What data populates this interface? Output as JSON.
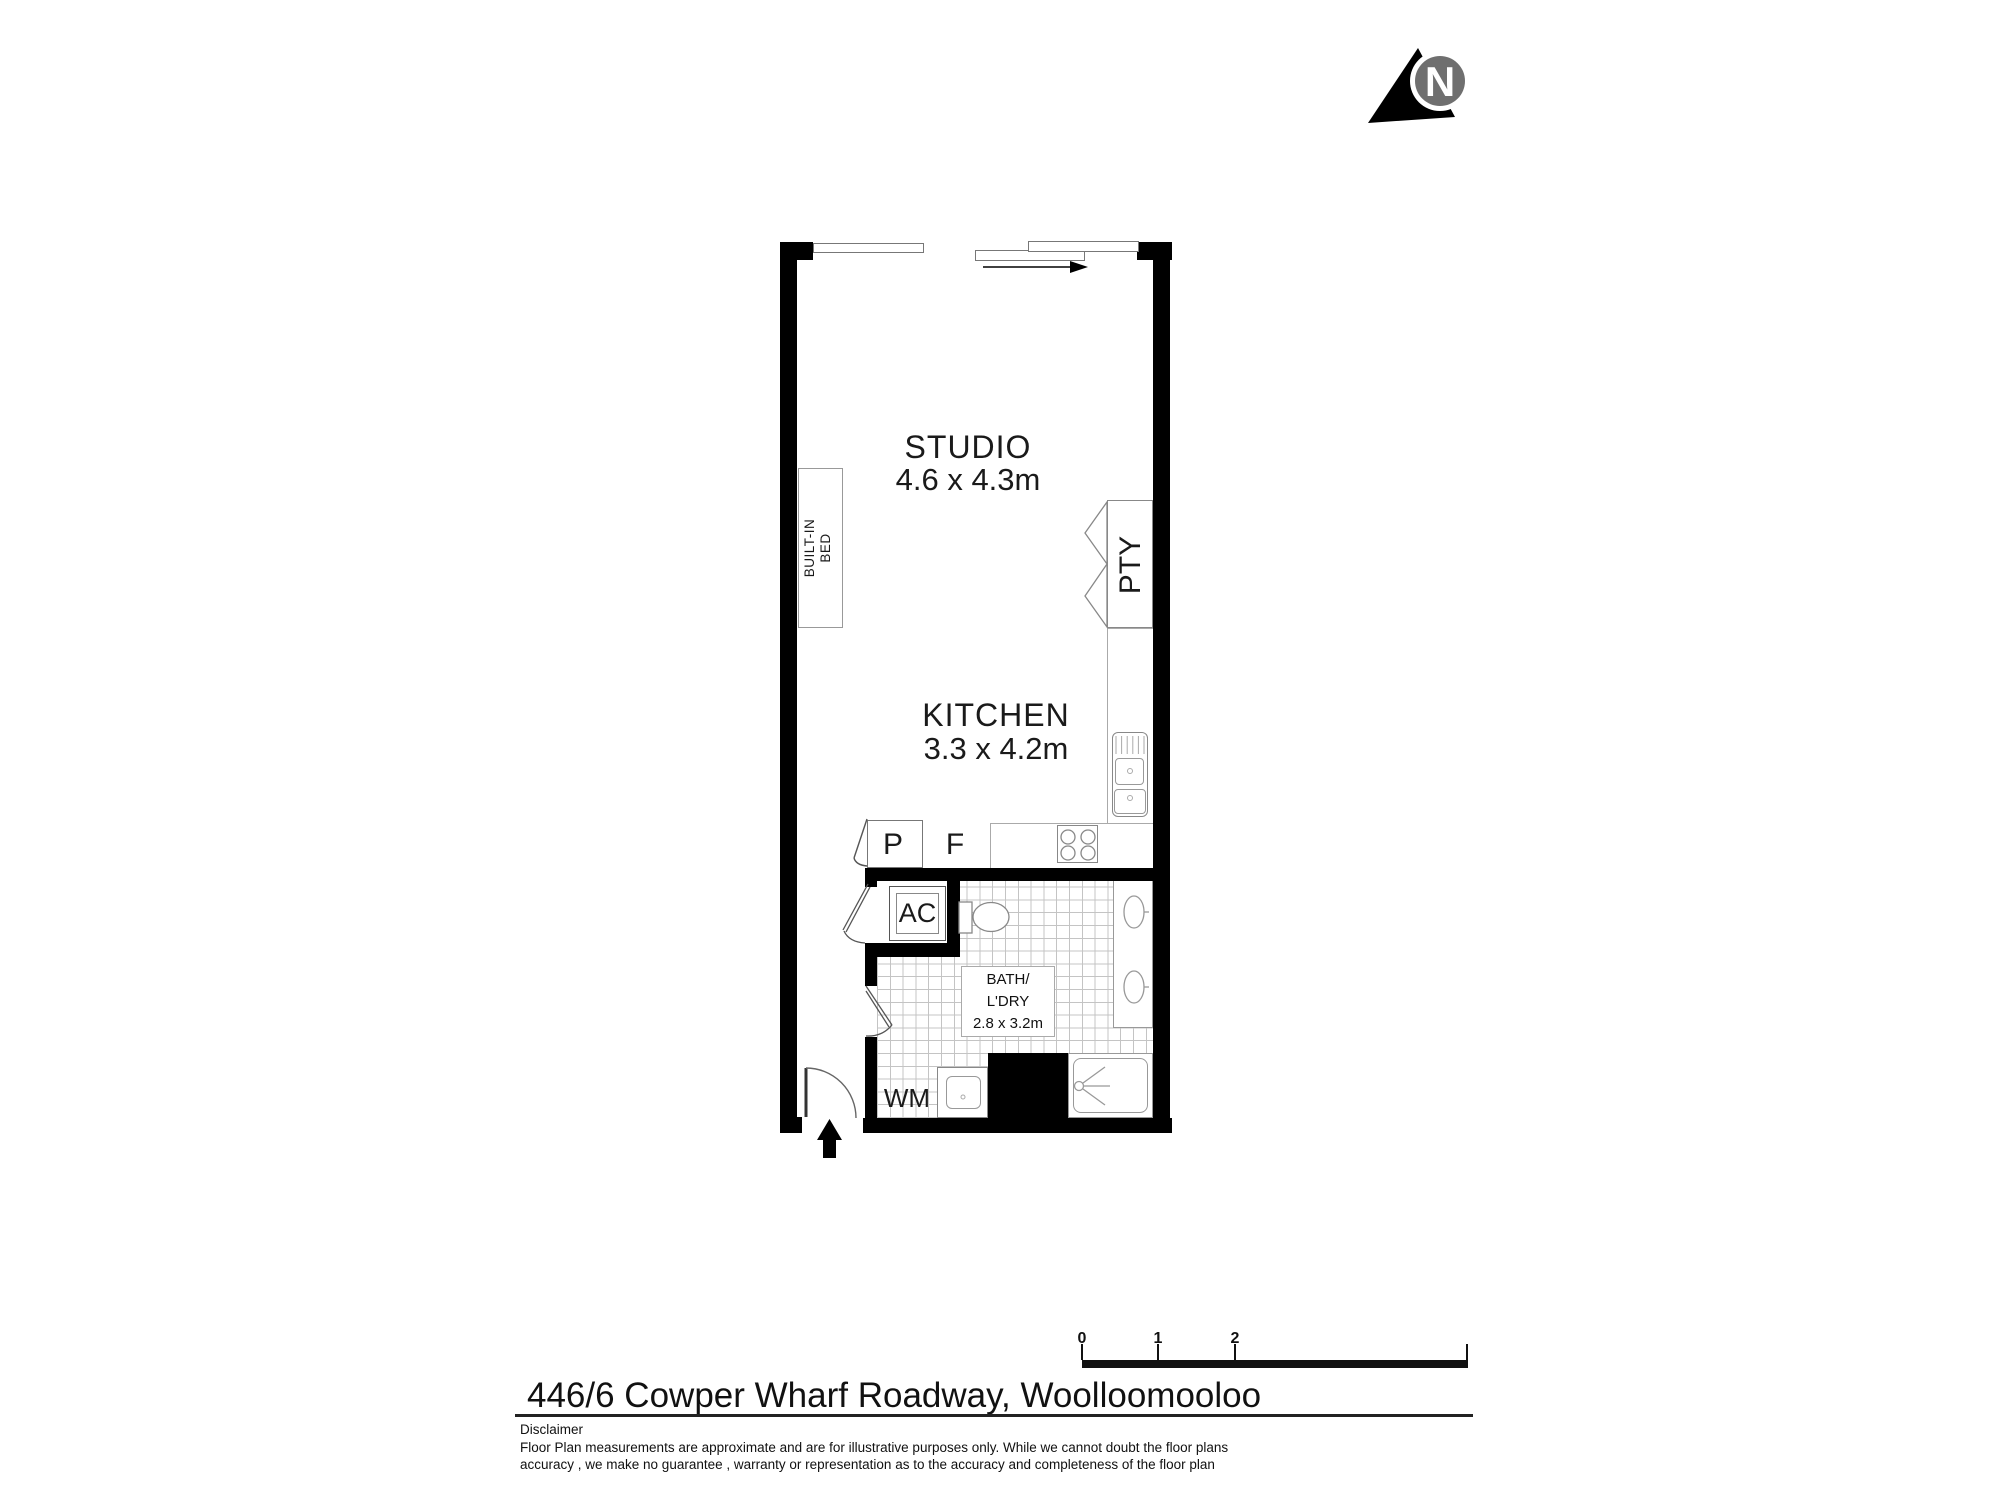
{
  "north": {
    "label": "N"
  },
  "rooms": {
    "studio": {
      "name": "STUDIO",
      "dims": "4.6 x 4.3m"
    },
    "kitchen": {
      "name": "KITCHEN",
      "dims": "3.3 x 4.2m"
    },
    "bath": {
      "name_line1": "BATH/",
      "name_line2": "L'DRY",
      "dims": "2.8 x 3.2m"
    }
  },
  "fixtures": {
    "built_in_bed_line1": "BUILT-IN",
    "built_in_bed_line2": "BED",
    "pantry": "PTY",
    "air_con": "AC",
    "cupboard": "P",
    "fridge": "F",
    "washing_machine": "WM"
  },
  "scale_bar": {
    "ticks": [
      "0",
      "1",
      "2",
      "5"
    ]
  },
  "footer": {
    "address": "446/6 Cowper Wharf Roadway, Woolloomooloo",
    "disclaimer_title": "Disclaimer",
    "disclaimer_line1": "Floor Plan measurements are approximate and are for illustrative purposes only. While we cannot doubt the floor plans",
    "disclaimer_line2": "accuracy , we make no guarantee , warranty or representation as to the accuracy and completeness of the floor plan"
  }
}
